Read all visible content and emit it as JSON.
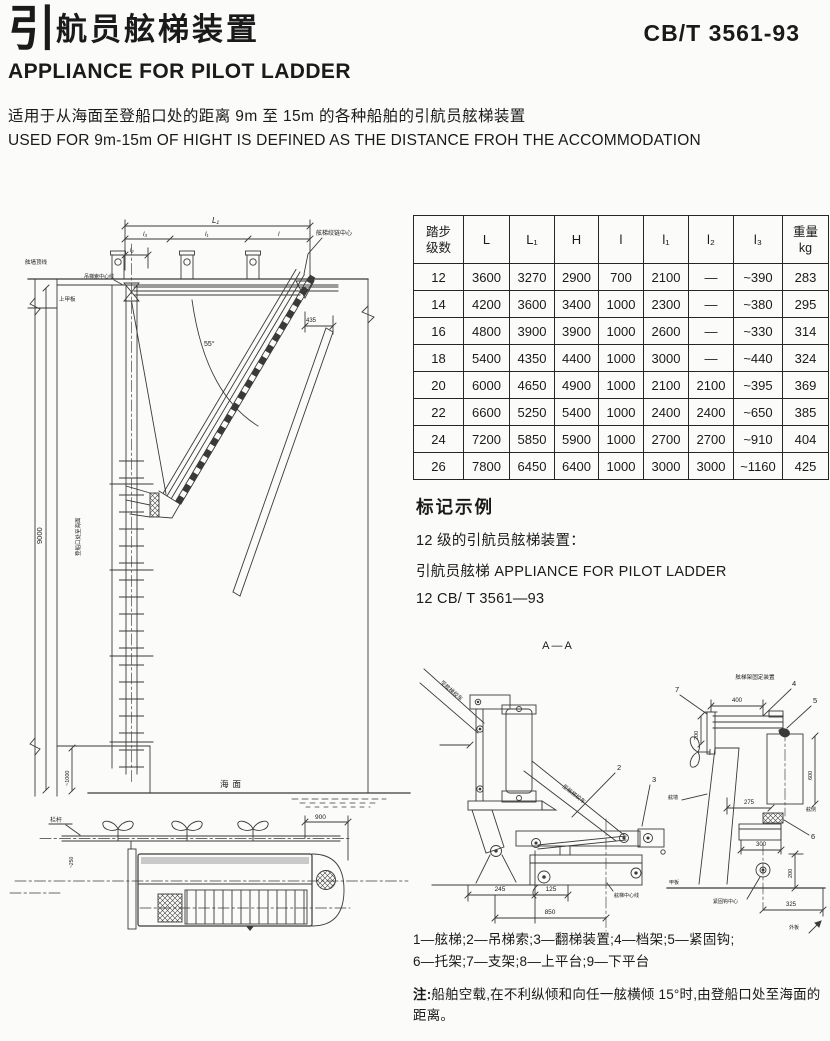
{
  "header": {
    "title_zh_lead": "引",
    "title_zh_rest": "航员舷梯装置",
    "title_en": "APPLIANCE FOR PILOT LADDER",
    "standard_code": "CB/T 3561-93"
  },
  "intro": {
    "zh": "适用于从海面至登船口处的距离 9m 至 15m 的各种船舶的引航员舷梯装置",
    "en": "USED FOR 9m-15m OF HIGHT IS DEFINED AS THE DISTANCE FROH THE ACCOMMODATION"
  },
  "spec_table": {
    "header": {
      "col0": [
        "踏步",
        "级数"
      ],
      "cols": [
        "L",
        "L₁",
        "H",
        "l",
        "l₁",
        "l₂",
        "l₃"
      ],
      "weight": [
        "重量",
        "kg"
      ]
    },
    "rows": [
      [
        "12",
        "3600",
        "3270",
        "2900",
        "700",
        "2100",
        "—",
        "~390",
        "283"
      ],
      [
        "14",
        "4200",
        "3600",
        "3400",
        "1000",
        "2300",
        "—",
        "~380",
        "295"
      ],
      [
        "16",
        "4800",
        "3900",
        "3900",
        "1000",
        "2600",
        "—",
        "~330",
        "314"
      ],
      [
        "18",
        "5400",
        "4350",
        "4400",
        "1000",
        "3000",
        "—",
        "~440",
        "324"
      ],
      [
        "20",
        "6000",
        "4650",
        "4900",
        "1000",
        "2100",
        "2100",
        "~395",
        "369"
      ],
      [
        "22",
        "6600",
        "5250",
        "5400",
        "1000",
        "2400",
        "2400",
        "~650",
        "385"
      ],
      [
        "24",
        "7200",
        "5850",
        "5900",
        "1000",
        "2700",
        "2700",
        "~910",
        "404"
      ],
      [
        "26",
        "7800",
        "6450",
        "6400",
        "1000",
        "3000",
        "3000",
        "~1160",
        "425"
      ]
    ]
  },
  "marking_example": {
    "heading": "标记示例",
    "line1": "12 级的引航员舷梯装置：",
    "line2": "引航员舷梯 APPLIANCE FOR PILOT LADDER",
    "line3": "12 CB/ T 3561—93"
  },
  "legend": {
    "line1": "1—舷梯;2—吊梯索;3—翻梯装置;4—档架;5—紧固钩;",
    "line2": "6—托架;7—支架;8—上平台;9—下平台"
  },
  "note": {
    "label": "注:",
    "text": "船舶空载,在不利纵倾和向任一舷横倾 15°时,由登船口处至海面的距离。"
  },
  "elevation": {
    "dim_overall": "L₁",
    "dim_seg1": "l₃",
    "dim_seg2": "l₁",
    "dim_seg3": "l",
    "dim_small": "l₂",
    "dim_height": "9000",
    "dim_platform": "~1000",
    "dim_435": "435",
    "angle_55": "55°",
    "label_bulwark_top": "舷墙顶线",
    "label_upper_deck": "上甲板",
    "label_davit_center": "吊梯索中心线",
    "label_hinge_center": "舷梯绞链中心",
    "label_height_note": "登船口处至海面",
    "label_sea": "海面"
  },
  "plan": {
    "label_rail": "栏杆",
    "dim_900": "900",
    "dim_250": "~250"
  },
  "section_aa": {
    "title": "A—A",
    "label_winch_upper": "至舷梯绞车",
    "label_winch_lower": "至舷梯绞车",
    "callout_2": "2",
    "callout_3": "3",
    "dim_245": "245",
    "dim_125": "125",
    "dim_850": "850",
    "label_centerline": "舷梯中心线"
  },
  "detail": {
    "title": "舷梯架固定装置",
    "callout_4": "4",
    "callout_5": "5",
    "callout_6": "6",
    "callout_7": "7",
    "dim_400": "400",
    "dim_200_left": "200",
    "dim_600": "600",
    "dim_275": "275",
    "dim_300": "300",
    "dim_200_right": "200",
    "dim_325": "325",
    "label_bulwark": "舷墙",
    "label_side": "舷侧",
    "label_deck": "甲板",
    "label_hook_center": "紧固钩中心",
    "label_shell": "外板"
  }
}
